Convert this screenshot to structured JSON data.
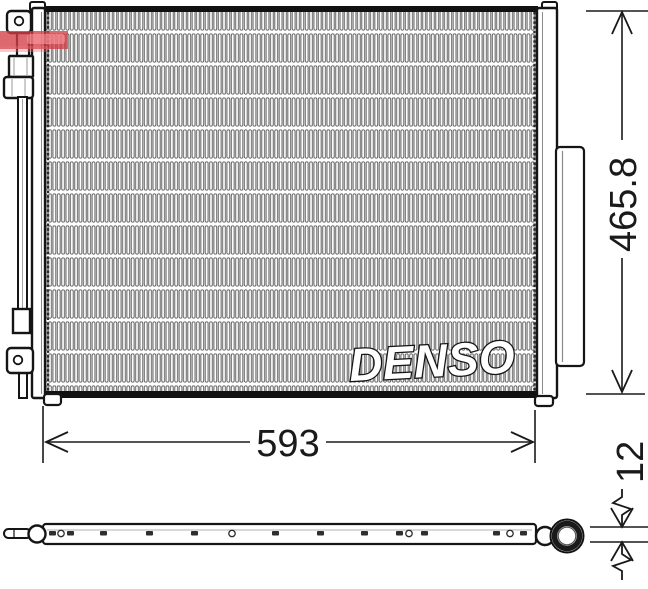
{
  "drawing": {
    "brand_watermark": "DENSO",
    "dimensions": {
      "width": "593",
      "height": "465.8",
      "thickness": "12"
    },
    "views": {
      "front": "condenser-front-view",
      "bottom": "condenser-bottom-strip-view"
    },
    "colors": {
      "line": "#1a1a1a",
      "fin_stroke": "#5d5d5d",
      "seller_watermark_red": "#d43f47",
      "background": "#ffffff"
    }
  }
}
